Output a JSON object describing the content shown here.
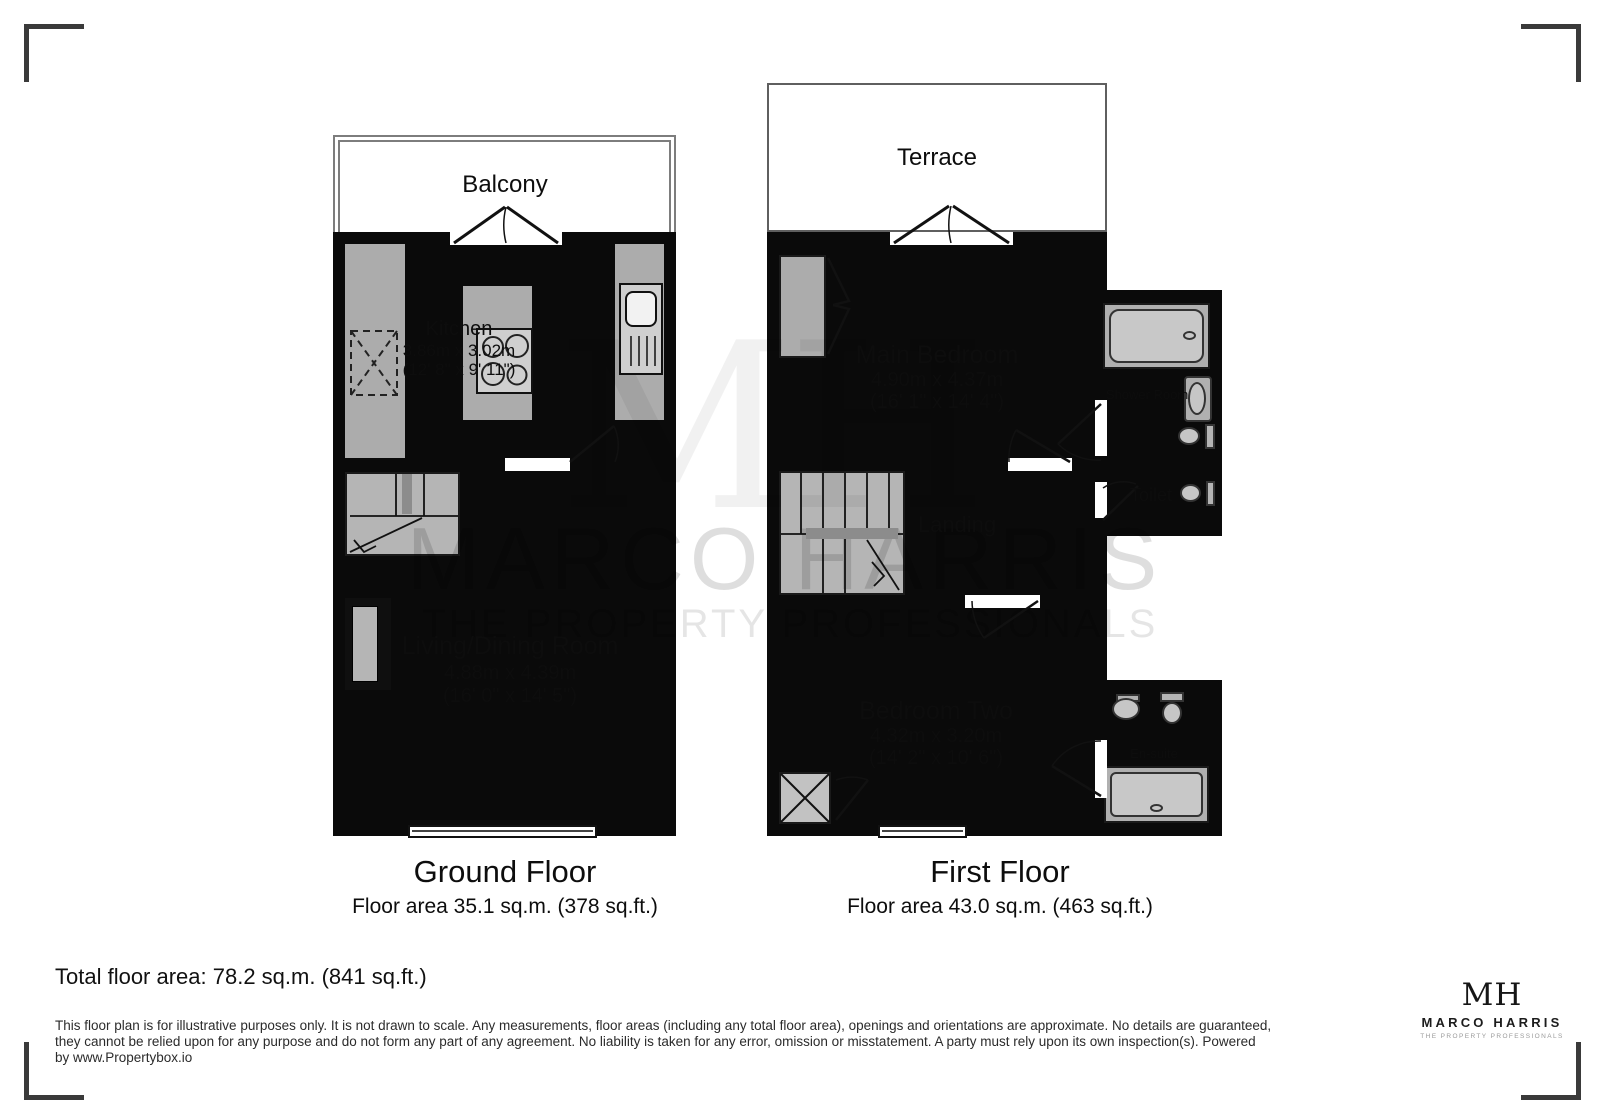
{
  "watermark": {
    "monogram": "MH",
    "line1": "MARCO HARRIS",
    "line2": "THE PROPERTY PROFESSIONALS"
  },
  "ground_floor": {
    "title": "Ground Floor",
    "area_label": "Floor area 35.1 sq.m. (378 sq.ft.)",
    "balcony": "Balcony",
    "kitchen": {
      "name": "Kitchen",
      "metric": "3.86m x 3.02m",
      "imperial": "(12' 8\" x 9' 11\")"
    },
    "living": {
      "name": "Living/Dining Room",
      "metric": "4.88m x 4.39m",
      "imperial": "(16' 0\" x 14' 5\")"
    }
  },
  "first_floor": {
    "title": "First Floor",
    "area_label": "Floor area 43.0 sq.m. (463 sq.ft.)",
    "terrace": "Terrace",
    "main_bedroom": {
      "name": "Main Bedroom",
      "metric": "4.90m x 4.37m",
      "imperial": "(16' 1\" x 14' 4\")"
    },
    "shower_room": {
      "name": "Shower Room"
    },
    "toilet": {
      "name": "Toilet"
    },
    "landing": {
      "name": "Landing"
    },
    "bedroom_two": {
      "name": "Bedroom Two",
      "metric": "4.32m x 3.20m",
      "imperial": "(14' 2\" x 10' 6\")"
    },
    "ensuite": {
      "name": "En-suite"
    }
  },
  "summary": {
    "total_area": "Total floor area: 78.2 sq.m. (841 sq.ft.)"
  },
  "disclaimer": {
    "line1": "This floor plan is for illustrative purposes only. It is not drawn to scale. Any measurements, floor areas (including any total floor area), openings and orientations are approximate. No details are guaranteed,",
    "line2": "they cannot be relied upon for any purpose and do not form any part of any agreement. No liability is taken for any error, omission or misstatement. A party must rely upon its own inspection(s). Powered",
    "line3": "by www.Propertybox.io"
  },
  "logo": {
    "monogram": "MH",
    "name": "MARCO HARRIS",
    "tagline": "THE PROPERTY PROFESSIONALS"
  },
  "colors": {
    "wall": "#0a0a0a",
    "ground_room": "#faf6de",
    "bedroom": "#f4e4ab",
    "landing": "#c7a472",
    "bathroom": "#a8eaf6",
    "fixture_gray": "#acacac"
  }
}
